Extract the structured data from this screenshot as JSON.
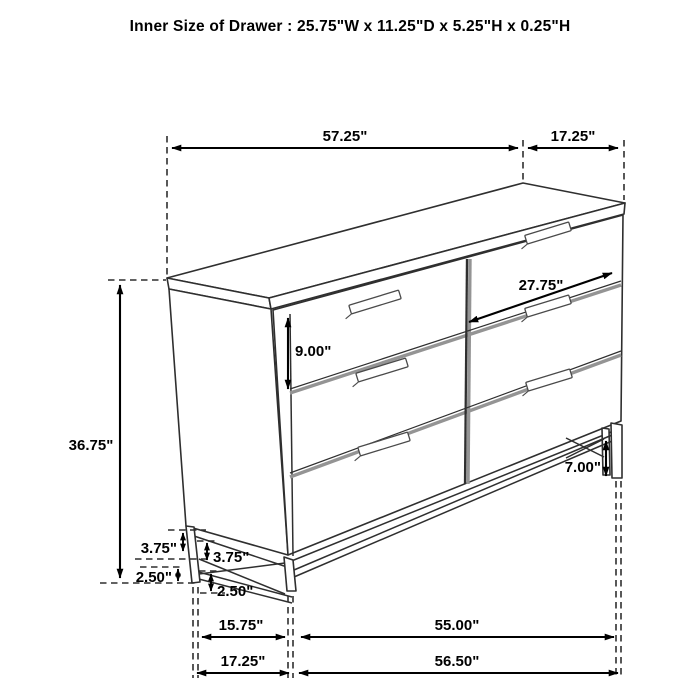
{
  "title": "Inner Size of Drawer : 25.75\"W x 11.25\"D x 5.25\"H x 0.25\"H",
  "dimensions": {
    "top": {
      "width": "57.25\"",
      "depth": "17.25\""
    },
    "height": {
      "overall": "36.75\""
    },
    "drawer": {
      "width": "27.75\"",
      "height": "9.00\""
    },
    "base": {
      "leg_height": "7.00\"",
      "side_upper": "3.75\"",
      "front_upper": "3.75\"",
      "side_lower": "2.50\"",
      "front_lower": "2.50\""
    },
    "footprint": {
      "side_inner": "15.75\"",
      "front_inner": "55.00\"",
      "side_outer": "17.25\"",
      "front_outer": "56.50\""
    }
  },
  "colors": {
    "background": "#ffffff",
    "line": "#2f2f2f",
    "separator": "#949494",
    "dimension": "#000000",
    "text": "#000000"
  }
}
